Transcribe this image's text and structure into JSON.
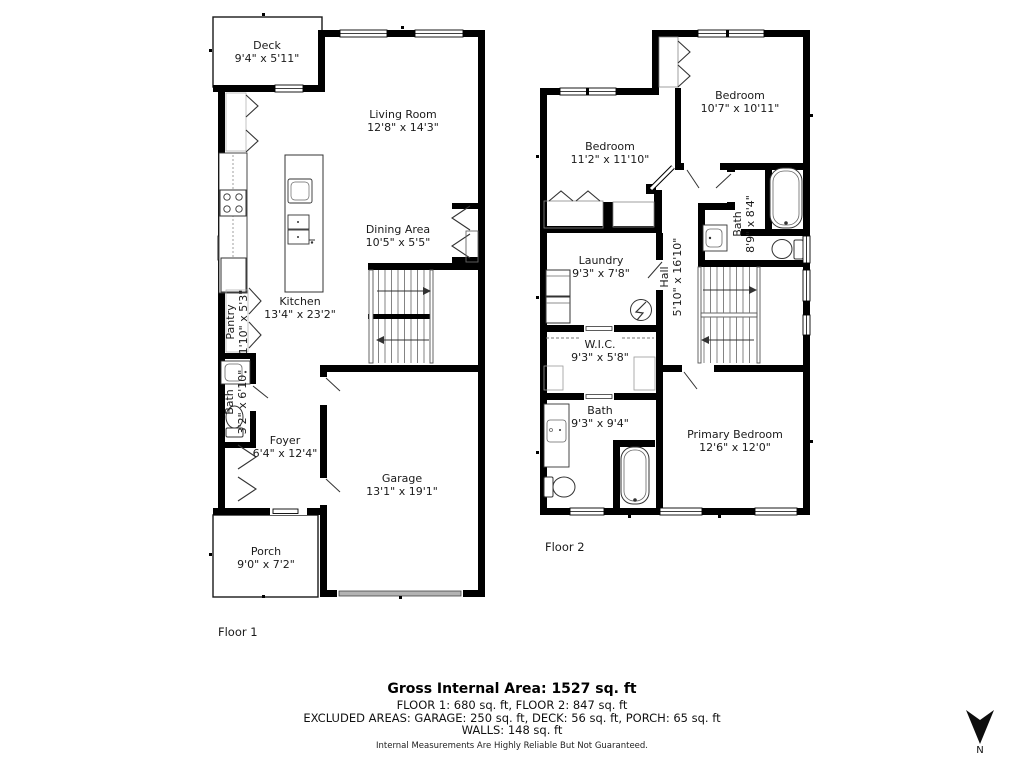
{
  "floor1": {
    "label": "Floor 1",
    "deck": {
      "name": "Deck",
      "dims": "9'4\" x 5'11\""
    },
    "living_room": {
      "name": "Living Room",
      "dims": "12'8\" x 14'3\""
    },
    "dining_area": {
      "name": "Dining Area",
      "dims": "10'5\" x 5'5\""
    },
    "kitchen": {
      "name": "Kitchen",
      "dims": "13'4\" x 23'2\""
    },
    "pantry": {
      "name": "Pantry",
      "dims": "1'10\" x 5'3\""
    },
    "bath": {
      "name": "Bath",
      "dims": "3'2\" x 6'10\""
    },
    "foyer": {
      "name": "Foyer",
      "dims": "6'4\" x 12'4\""
    },
    "garage": {
      "name": "Garage",
      "dims": "13'1\" x 19'1\""
    },
    "porch": {
      "name": "Porch",
      "dims": "9'0\" x 7'2\""
    }
  },
  "floor2": {
    "label": "Floor 2",
    "bedroom_right": {
      "name": "Bedroom",
      "dims": "10'7\" x 10'11\""
    },
    "bedroom_left": {
      "name": "Bedroom",
      "dims": "11'2\" x 11'10\""
    },
    "bath_top": {
      "name": "Bath",
      "dims": "8'9\" x 8'4\""
    },
    "laundry": {
      "name": "Laundry",
      "dims": "9'3\" x 7'8\""
    },
    "hall": {
      "name": "Hall",
      "dims": "5'10\" x 16'10\""
    },
    "wic": {
      "name": "W.I.C.",
      "dims": "9'3\" x 5'8\""
    },
    "bath_bottom": {
      "name": "Bath",
      "dims": "9'3\" x 9'4\""
    },
    "primary_bedroom": {
      "name": "Primary Bedroom",
      "dims": "12'6\" x 12'0\""
    }
  },
  "summary": {
    "title": "Gross Internal Area: 1527 sq. ft",
    "floors": "FLOOR 1: 680 sq. ft, FLOOR 2: 847 sq. ft",
    "excluded": "EXCLUDED AREAS: GARAGE: 250 sq. ft, DECK: 56 sq. ft, PORCH: 65 sq. ft",
    "walls": "WALLS: 148 sq. ft",
    "disclaimer": "Internal Measurements Are Highly Reliable But Not Guaranteed."
  },
  "compass": {
    "label": "N"
  },
  "colors": {
    "wall": "#000000",
    "garage_door": "#b3b3b3",
    "fixture_line": "#333333",
    "stair_line": "#777777",
    "text": "#1a1a1a"
  }
}
